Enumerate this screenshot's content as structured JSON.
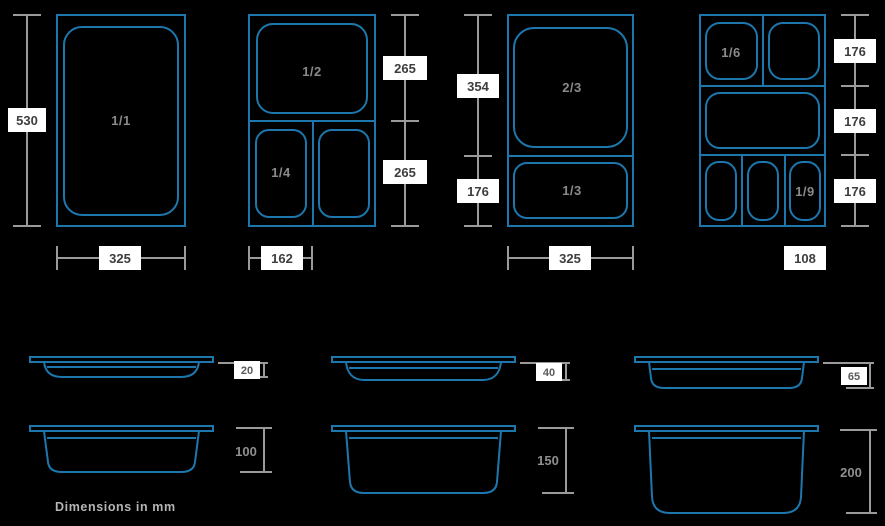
{
  "title": "Gastronorm pan sizes diagram",
  "footer_note": "Dimensions in mm",
  "colors": {
    "background": "#000000",
    "pan_outline_blue": "#1d77ad",
    "dimension_line_gray": "#9a9a9a",
    "label_box_bg": "#ffffff",
    "label_text": "#3d3d3d",
    "fraction_text": "#8a8a8a"
  },
  "pans": {
    "p11": {
      "label": "1/1",
      "height_mm": "530",
      "width_mm": "325"
    },
    "p12": {
      "label_half": "1/2",
      "label_quarter": "1/4",
      "dim_top": "265",
      "dim_bottom": "265",
      "width_mm": "162"
    },
    "p23": {
      "label_two_thirds": "2/3",
      "label_third": "1/3",
      "dim_top": "354",
      "dim_bottom": "176",
      "width_mm": "325"
    },
    "p19": {
      "label_sixth": "1/6",
      "label_ninth": "1/9",
      "dim_row_top": "176",
      "dim_row_mid": "176",
      "dim_row_bottom": "176",
      "width_mm": "108"
    }
  },
  "depths": {
    "shallow": [
      "20",
      "40",
      "65"
    ],
    "deep": [
      "100",
      "150",
      "200"
    ]
  }
}
